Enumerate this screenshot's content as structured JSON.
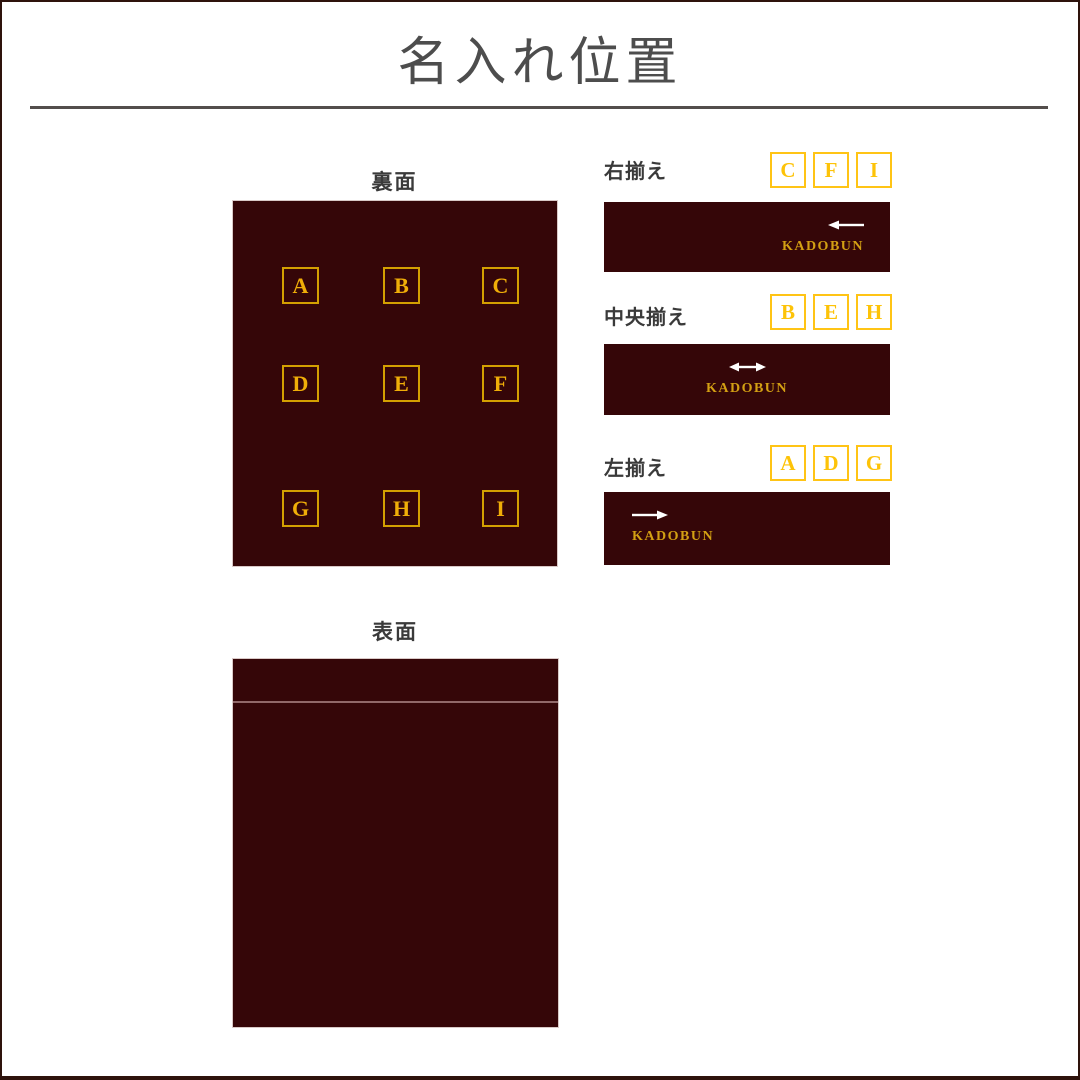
{
  "page": {
    "title": "名入れ位置"
  },
  "back": {
    "label": "裏面",
    "letters": [
      "A",
      "B",
      "C",
      "D",
      "E",
      "F",
      "G",
      "H",
      "I"
    ]
  },
  "front": {
    "label": "表面"
  },
  "blocks": [
    {
      "label": "右揃え",
      "letters": [
        "C",
        "F",
        "I"
      ],
      "arrow_direction": "left",
      "brand": "KADOBUN"
    },
    {
      "label": "中央揃え",
      "letters": [
        "B",
        "E",
        "H"
      ],
      "arrow_direction": "both",
      "brand": "KADOBUN"
    },
    {
      "label": "左揃え",
      "letters": [
        "A",
        "D",
        "G"
      ],
      "arrow_direction": "right",
      "brand": "KADOBUN"
    }
  ],
  "colors": {
    "panel_maroon": "#350608",
    "grid_letter_gold": "#f0ae08",
    "grid_border_gold": "#d3a001",
    "badge_yellow_border": "#ffc415",
    "badge_yellow_letter": "#fdc308",
    "brand_gold": "#d3a013",
    "title_gray": "#4d4d4d",
    "arrow_white": "#ffffff"
  }
}
